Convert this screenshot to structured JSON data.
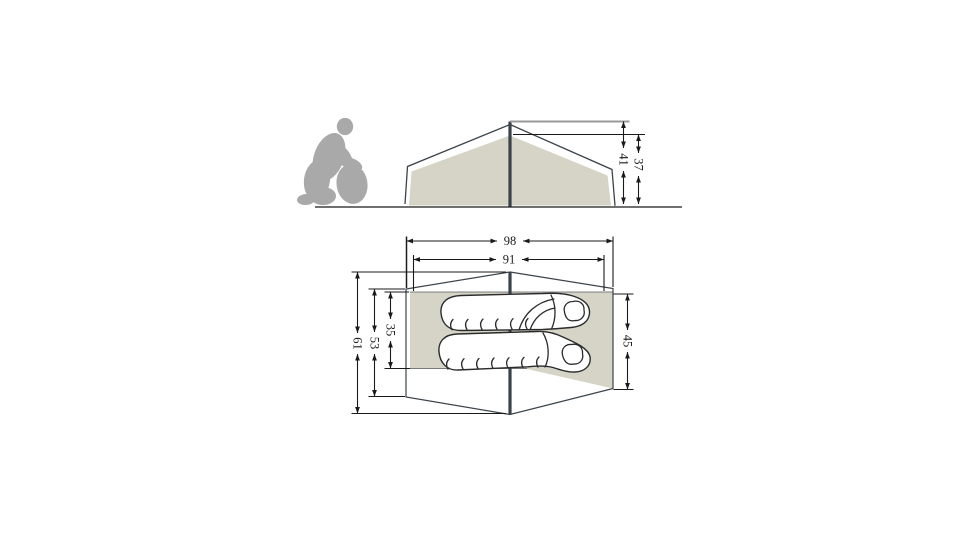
{
  "diagram": {
    "type": "tent-dimension-drawing",
    "views": {
      "side_view": {
        "figures": [
          "kneeling-person-silhouette",
          "tent-side-elevation",
          "center-pole",
          "ground-line"
        ],
        "dimensions": [
          {
            "name": "peak_height",
            "value": "41"
          },
          {
            "name": "inner_height",
            "value": "37"
          }
        ]
      },
      "top_view": {
        "figures": [
          "tent-floor-plan",
          "center-pole",
          "sleeping-bag-top",
          "sleeping-bag-bottom"
        ],
        "dimensions": [
          {
            "name": "outer_width",
            "value": "98"
          },
          {
            "name": "inner_width",
            "value": "91"
          },
          {
            "name": "total_depth",
            "value": "61"
          },
          {
            "name": "mid_depth",
            "value": "53"
          },
          {
            "name": "sleeping_depth_left",
            "value": "35"
          },
          {
            "name": "sleeping_depth_right",
            "value": "45"
          }
        ]
      }
    }
  },
  "measurements": {
    "peak_height": "41",
    "inner_height": "37",
    "outer_width": "98",
    "inner_width": "91",
    "total_depth": "61",
    "mid_depth": "53",
    "sleeping_depth_left": "35",
    "sleeping_depth_right": "45"
  },
  "colors": {
    "background": "#ffffff",
    "tent_fill": "#d5d4c7",
    "tent_outline": "#3a444a",
    "pole": "#39434a",
    "silhouette": "#a9a9a9",
    "dimension_line": "#1a1a1a",
    "extension_gray": "#999999",
    "bag_outline": "#2b2b2b"
  }
}
